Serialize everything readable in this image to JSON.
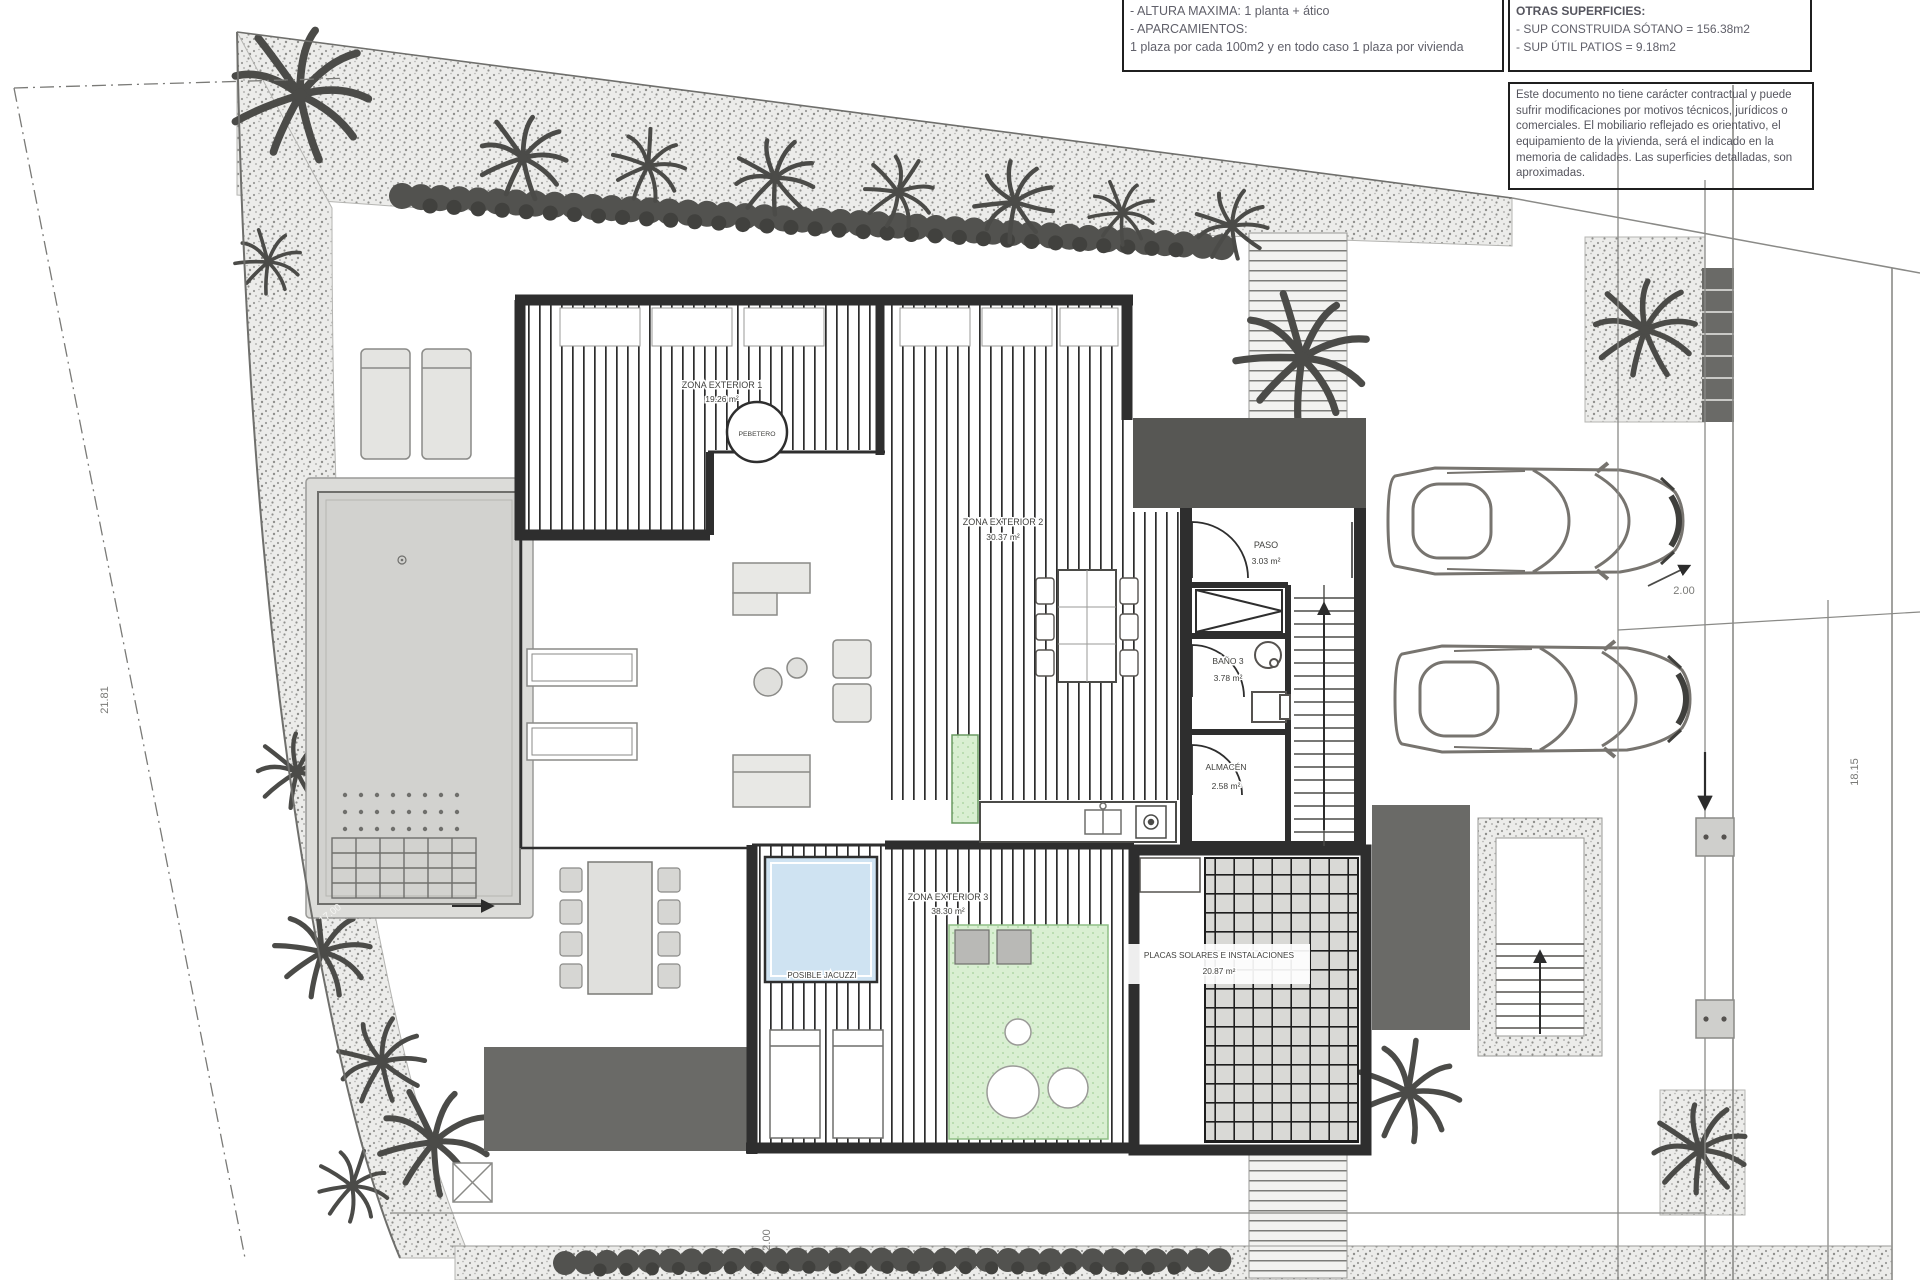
{
  "notes_box": {
    "line1": "- ALTURA MAXIMA: 1 planta + ático",
    "line2": "- APARCAMIENTOS:",
    "line3": "1 plaza por cada 100m2 y en todo caso 1 plaza por vivienda"
  },
  "surfaces_box": {
    "title": "OTRAS SUPERFICIES:",
    "line1": "- SUP CONSTRUIDA SÓTANO =  156.38m2",
    "line2": "- SUP ÚTIL PATIOS =  9.18m2"
  },
  "disclaimer": {
    "text": "Este documento no tiene carácter contractual y puede sufrir modificaciones por motivos técnicos, jurídicos o comerciales. El mobiliario reflejado es orientativo, el equipamiento de la vivienda, será el indicado en la memoria de calidades. Las superficies detalladas, son aproximadas."
  },
  "rooms": {
    "zona_exterior_1": {
      "name": "ZONA EXTERIOR 1",
      "area": "19.26 m²"
    },
    "zona_exterior_2": {
      "name": "ZONA EXTERIOR 2",
      "area": "30.37 m²"
    },
    "zona_exterior_3": {
      "name": "ZONA EXTERIOR 3",
      "area": "38.30 m²"
    },
    "paso": {
      "name": "PASO",
      "area": "3.03 m²"
    },
    "bano_3": {
      "name": "BAÑO 3",
      "area": "3.78 m²"
    },
    "almacen": {
      "name": "ALMACÉN",
      "area": "2.58 m²"
    },
    "placas": {
      "name": "PLACAS SOLARES E INSTALACIONES",
      "area": "20.87 m²"
    },
    "pebetero": {
      "name": "PEBETERO"
    },
    "jacuzzi": {
      "name": "POSIBLE JACUZZI"
    }
  },
  "dimensions": {
    "left": "21.81",
    "right": "18.15",
    "parking": "2.00",
    "bottom": "2.00",
    "pool": "17.00"
  },
  "colors": {
    "wall": "#2e2e2e",
    "garden_dot": "#9a9a97",
    "lawn_green": "#d9efd2",
    "jacuzzi_blue": "#cfe3f2",
    "slab_gray": "#6a6a67",
    "porch_gray": "#575754"
  }
}
